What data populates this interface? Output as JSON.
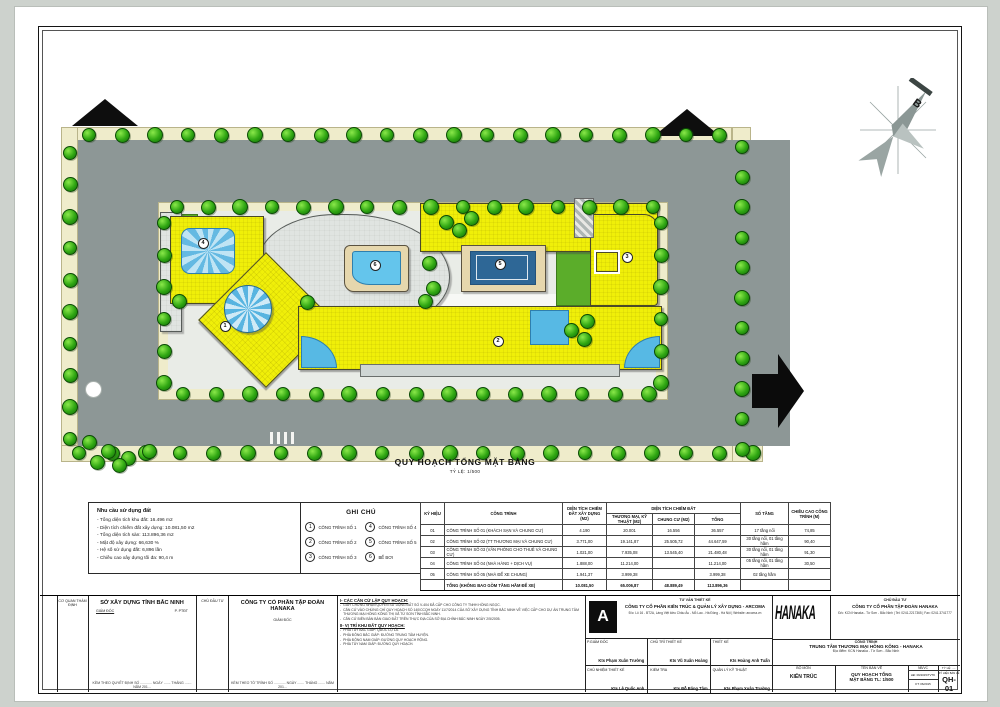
{
  "plan": {
    "title": "QUY HOẠCH TỔNG MẶT BẰNG",
    "scale": "TỶ LỆ: 1/500",
    "north_label": "B",
    "markers": [
      {
        "n": "1",
        "x": 224,
        "y": 325
      },
      {
        "n": "2",
        "x": 497,
        "y": 340
      },
      {
        "n": "3",
        "x": 626,
        "y": 256
      },
      {
        "n": "4",
        "x": 202,
        "y": 242
      },
      {
        "n": "5",
        "x": 499,
        "y": 263
      },
      {
        "n": "6",
        "x": 374,
        "y": 264
      }
    ]
  },
  "land_use": {
    "title": "Nhu cầu sử dụng đất",
    "items": [
      {
        "label": "Tổng diện tích khu đất:",
        "value": "16.496 m2"
      },
      {
        "label": "Diện tích chiếm đất xây dựng:",
        "value": "10.081,50 m2"
      },
      {
        "label": "Tổng diện tích sàn:",
        "value": "113.896,36 m2"
      },
      {
        "label": "Mật độ xây dựng:",
        "value": "66,630 %"
      },
      {
        "label": "Hệ số sử dụng đất:",
        "value": "6,896 lần"
      },
      {
        "label": "Chiều cao xây dựng tối đa:",
        "value": "90,4 m"
      }
    ]
  },
  "legend": {
    "title": "GHI CHÚ",
    "items": [
      {
        "num": "1",
        "label": "CÔNG TRÌNH SỐ 1"
      },
      {
        "num": "2",
        "label": "CÔNG TRÌNH SỐ 2"
      },
      {
        "num": "3",
        "label": "CÔNG TRÌNH SỐ 3"
      },
      {
        "num": "4",
        "label": "CÔNG TRÌNH SỐ 4"
      },
      {
        "num": "5",
        "label": "CÔNG TRÌNH SỐ 5"
      },
      {
        "num": "6",
        "label": "BỂ BƠI"
      }
    ]
  },
  "table": {
    "header": {
      "ky_hieu": "KÝ HIỆU",
      "cong_trinh": "CÔNG TRÌNH",
      "xay_dung": "DIỆN TÍCH CHIẾM ĐẤT XÂY DỰNG (M2)",
      "group": "DIỆN TÍCH CHIẾM ĐẤT",
      "thuong_mai": "THƯƠNG MẠI, KỸ THUẬT (M2)",
      "chung_cu": "CHUNG CƯ (M2)",
      "tong": "TỔNG",
      "so_tang": "SỐ TẦNG",
      "chieu_cao": "CHIỀU CAO CÔNG TRÌNH (M)"
    },
    "rows": [
      [
        "01",
        "CÔNG TRÌNH SỐ 01 (KHÁCH SẠN VÀ CHUNG CƯ)",
        "4.190",
        "20.001",
        "16.556",
        "36.557",
        "17 tầng nổi",
        "74,85"
      ],
      [
        "02",
        "CÔNG TRÌNH SỐ 02 (TT THƯƠNG MẠI VÀ CHUNG CƯ)",
        "3.771,00",
        "19.141,87",
        "25.505,72",
        "44.647,59",
        "30 tầng nổi, 01 tầng hầm",
        "90,40"
      ],
      [
        "03",
        "CÔNG TRÌNH SỐ 03 (VĂN PHÒNG CHO THUÊ VÀ CHUNG CƯ)",
        "1.021,00",
        "7.935,08",
        "13.545,40",
        "21.480,48",
        "30 tầng nổi, 01 tầng hầm",
        "91,30"
      ],
      [
        "04",
        "CÔNG TRÌNH SỐ 04 (NHÀ HÀNG + DỊCH VỤ)",
        "1.888,00",
        "11.214,00",
        "",
        "11.214,00",
        "05 tầng nổi, 01 tầng hầm",
        "30,50"
      ],
      [
        "05",
        "CÔNG TRÌNH SỐ 05 (NHÀ ĐỂ XE CHUNG)",
        "1.941,37",
        "3.999,38",
        "",
        "3.999,38",
        "02 tầng hầm",
        ""
      ]
    ],
    "total": [
      "",
      "TỔNG (KHÔNG BAO GỒM TẦNG HẦM ĐỂ XE)",
      "10.081,50",
      "65.006,87",
      "48.889,49",
      "113.896,36",
      "",
      ""
    ]
  },
  "approval": {
    "agency_col_label": "CƠ QUAN THẨM ĐỊNH",
    "agency": "SỞ XÂY DỰNG TỈNH BẮC NINH",
    "agency_role_left": "GIÁM ĐỐC",
    "agency_role_right": "P. PTĐT",
    "agency_footer": "KÈM THEO QUYẾT ĐỊNH SỐ ............ NGÀY ....... THÁNG ....... NĂM 201...",
    "investor_col_label": "CHỦ ĐẦU TƯ",
    "investor_company": "CÔNG TY CỔ PHẦN TẬP ĐOÀN HANAKA",
    "investor_role": "GIÁM ĐỐC",
    "investor_footer": "KÈM THEO TỜ TRÌNH SỐ ............ NGÀY ....... THÁNG ....... NĂM 201..."
  },
  "notes": {
    "section1_title": "I- CÁC CĂN CỨ LẬP QUY HOẠCH:",
    "section1_items": [
      "GIẤY CHỨNG NHẬN QUYỀN SỬ DỤNG ĐẤT SỐ V-404 ĐÃ CẤP CHO CÔNG TY TNHH HỒNG NGỌC.",
      "CĂN CỨ VÀO CHỨNG CHỈ QUY HOẠCH SỐ 140/CCQH NGÀY 11/7/2014 CỦA SỞ XÂY DỰNG TỈNH BẮC NINH VỀ VIỆC CẤP CHO DỰ ÁN TRUNG TÂM THƯƠNG MẠI HỒNG KÔNG THỊ XÃ TỪ SƠN TỈNH BẮC NINH.",
      "CĂN CỨ BIÊN BẢN BÀN GIAO ĐẤT TRÊN THỰC ĐỊA CỦA SỞ ĐỊA CHÍNH BẮC NINH NGÀY 2/5/2005."
    ],
    "section2_title": "II- VỊ TRÍ KHU ĐẤT QUY HOẠCH:",
    "section2_items": [
      "PHÍA TÂY BẮC GIÁP: QUỐC LỘ 1A.",
      "PHÍA ĐÔNG BẮC GIÁP: ĐƯỜNG TRUNG TÂM HUYỆN.",
      "PHÍA ĐÔNG NAM GIÁP: ĐƯỜNG QUY HOẠCH RỘNG.",
      "PHÍA TÂY NAM GIÁP: ĐƯỜNG QUY HOẠCH."
    ]
  },
  "consultant": {
    "label": "TƯ VẤN THIẾT KẾ",
    "company": "CÔNG TY CỔ PHẦN KIẾN TRÚC & QUẢN LÝ XÂY DỰNG - ARCOMA",
    "address": "Đ/c: Lô 16 - BT2A, Làng Việt kiều Châu Âu - Mỗ Lao - Hà Đông - Hà Nội | Website: arcoma.vn",
    "logo_letter": "A",
    "roles": [
      {
        "title": "P.GIÁM ĐỐC",
        "name": "Kts Phạm Xuân Trường"
      },
      {
        "title": "CHỦ TRÌ THIẾT KẾ",
        "name": "Kts Vũ Xuân Hoàng"
      },
      {
        "title": "THIẾT KẾ",
        "name": "Kts Hoàng Anh Tuấn"
      },
      {
        "title": "CHỦ NHIỆM THIẾT KẾ",
        "name": "Kts Lê Quốc Anh"
      },
      {
        "title": "KIỂM TRA",
        "name": "Kts Đỗ Băng Tâm"
      },
      {
        "title": "QUẢN LÝ KỸ THUẬT",
        "name": "Kts Phạm Xuân Trường"
      }
    ]
  },
  "investor": {
    "brand": "HANAKA",
    "label": "CHỦ ĐẦU TƯ",
    "company": "CÔNG TY CỔ PHẦN TẬP ĐOÀN HANAKA",
    "address": "Đ/c: KCN Hanaka - Từ Sơn - Bắc Ninh | Tel: 0241.2217365 | Fax: 0241.3741777",
    "project_label": "CÔNG TRÌNH",
    "project_name": "TRUNG TÂM THƯƠNG MẠI HỒNG KÔNG - HANAKA",
    "project_address": "Địa điểm: KCN Hanaka - Từ Sơn - Bắc Ninh",
    "bo_mon_label": "BỘ MÔN",
    "bo_mon": "KIẾN TRÚC",
    "ten_ban_ve_label": "TÊN BẢN VẼ",
    "ten_ban_ve_1": "QUY HOẠCH TỔNG",
    "ten_ban_ve_2": "MẶT BẰNG TL: 1/500",
    "nbvc_label": "NB/VC",
    "nbvc_1": "HĐ: 09/2015/TVTK",
    "nbvc_2": "KT: 06/2015",
    "ty_le_label": "TỶ LỆ: .....",
    "ky_hieu_label": "KÝ HIỆU BẢN VẼ",
    "drawing_no": "QH-01"
  }
}
